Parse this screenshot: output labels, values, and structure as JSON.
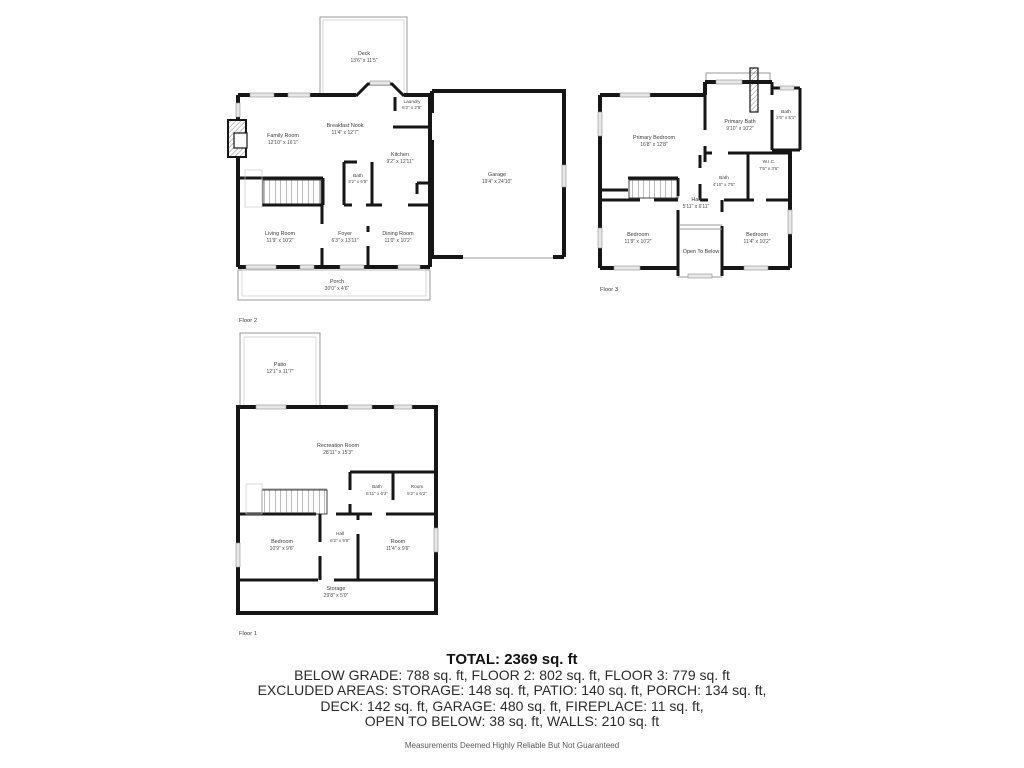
{
  "floor2": {
    "label": "Floor 2",
    "rooms": {
      "deck": {
        "name": "Deck",
        "dims": "13'6\" x 11'5\""
      },
      "laundry": {
        "name": "Laundry",
        "dims": "5'2\" x 2'9\""
      },
      "breakfast_nook": {
        "name": "Breakfast Nook",
        "dims": "11'4\" x 12'7\""
      },
      "family_room": {
        "name": "Family Room",
        "dims": "12'10\" x 16'1\""
      },
      "kitchen": {
        "name": "Kitchen",
        "dims": "9'2\" x 12'11\""
      },
      "bath": {
        "name": "Bath",
        "dims": "3'2\" x 6'9\""
      },
      "living_room": {
        "name": "Living Room",
        "dims": "11'9\" x 10'2\""
      },
      "foyer": {
        "name": "Foyer",
        "dims": "6'3\" x 13'11\""
      },
      "dining_room": {
        "name": "Dining Room",
        "dims": "11'0\" x 10'2\""
      },
      "garage": {
        "name": "Garage",
        "dims": "19'4\" x 24'10\""
      },
      "porch": {
        "name": "Porch",
        "dims": "30'0\" x 4'6\""
      }
    }
  },
  "floor3": {
    "label": "Floor 3",
    "rooms": {
      "primary_bedroom": {
        "name": "Primary Bedroom",
        "dims": "16'8\" x 12'8\""
      },
      "primary_bath": {
        "name": "Primary Bath",
        "dims": "9'10\" x 10'2\""
      },
      "bath_small": {
        "name": "Bath",
        "dims": "2'5\" x 5'1\""
      },
      "wic": {
        "name": "W.I.C.",
        "dims": "7'6\" x 3'6\""
      },
      "bath": {
        "name": "Bath",
        "dims": "4'10\" x 7'5\""
      },
      "hall": {
        "name": "Hall",
        "dims": "5'11\" x 6'11\""
      },
      "bedroom_left": {
        "name": "Bedroom",
        "dims": "11'9\" x 10'2\""
      },
      "open_to_below": {
        "name": "Open To Below"
      },
      "bedroom_right": {
        "name": "Bedroom",
        "dims": "11'4\" x 10'2\""
      }
    }
  },
  "floor1": {
    "label": "Floor 1",
    "rooms": {
      "patio": {
        "name": "Patio",
        "dims": "12'1\" x 11'7\""
      },
      "recreation_room": {
        "name": "Recreation Room",
        "dims": "28'11\" x 15'3\""
      },
      "bath": {
        "name": "Bath",
        "dims": "6'11\" x 6'2\""
      },
      "room_small": {
        "name": "Room",
        "dims": "5'2\" x 6'2\""
      },
      "hall": {
        "name": "Hall",
        "dims": "6'2\" x 9'6\""
      },
      "bedroom": {
        "name": "Bedroom",
        "dims": "10'9\" x 9'6\""
      },
      "room": {
        "name": "Room",
        "dims": "11'4\" x 9'6\""
      },
      "storage": {
        "name": "Storage",
        "dims": "29'8\" x 5'0\""
      }
    }
  },
  "summary": {
    "total": "TOTAL: 2369 sq. ft",
    "lines": [
      "BELOW GRADE: 788 sq. ft, FLOOR 2: 802 sq. ft, FLOOR 3: 779 sq. ft",
      "EXCLUDED AREAS: STORAGE: 148 sq. ft, PATIO: 140 sq. ft, PORCH: 134 sq. ft,",
      "DECK: 142 sq. ft, GARAGE: 480 sq. ft, FIREPLACE: 11 sq. ft,",
      "OPEN TO BELOW: 38 sq. ft, WALLS: 210 sq. ft"
    ],
    "disclaimer": "Measurements Deemed Highly Reliable But Not Guaranteed"
  }
}
